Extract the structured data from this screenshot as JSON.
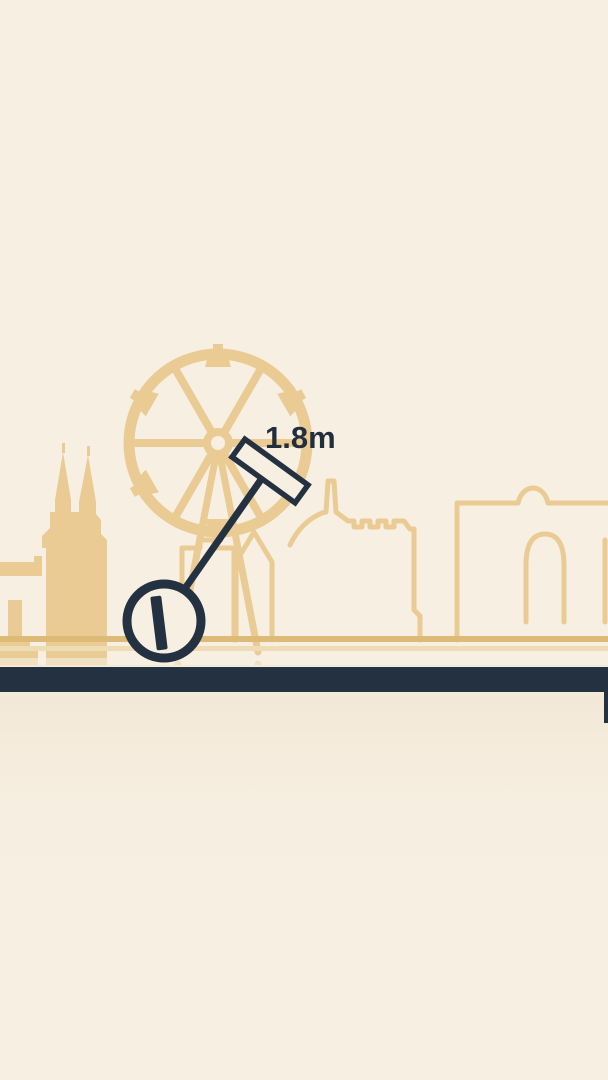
{
  "scene": {
    "type": "physics-balance-game",
    "distance_label": "1.8m",
    "elements": {
      "background": "cream sky",
      "skyline": "tan city skyline with ferris wheel, cathedral spires, monument, buildings, domed hall with arched window",
      "character": "dark wheel with pendulum arm and mallet head",
      "ground": "dark navy ground bar with faded mirrored skyline reflection below"
    }
  },
  "colors": {
    "background": "#f7efe2",
    "skyline_tan": "#e9cb93",
    "ground_line_tan": "#ddbb76",
    "ground_line_pale": "#eedcb5",
    "ink_navy": "#243140",
    "text": "#232e3d"
  },
  "icons": {
    "ferris_wheel": "ferris-wheel-icon",
    "cathedral": "cathedral-icon",
    "mallet": "mallet-icon"
  }
}
